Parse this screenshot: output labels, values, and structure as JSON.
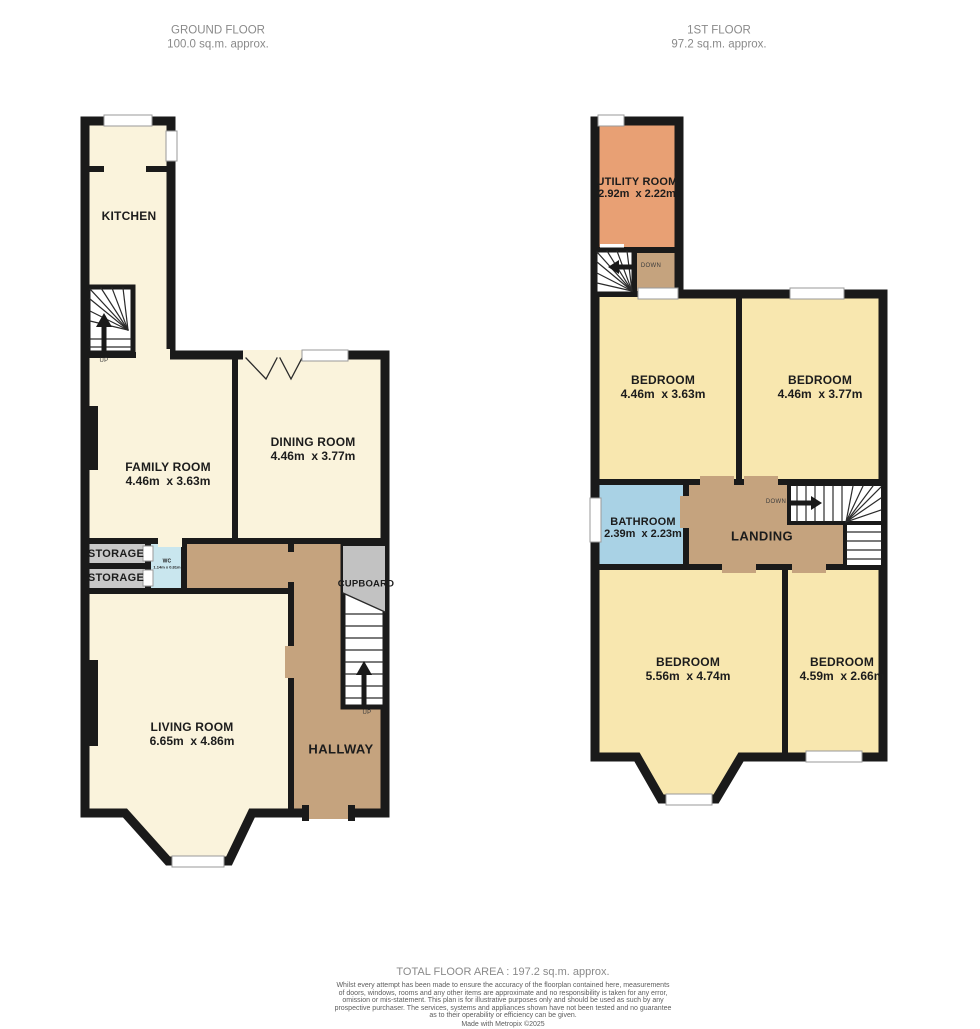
{
  "headers": {
    "ground": {
      "title": "GROUND FLOOR",
      "area": "100.0 sq.m. approx."
    },
    "first": {
      "title": "1ST FLOOR",
      "area": "97.2 sq.m. approx."
    }
  },
  "ground_floor": {
    "rooms": {
      "kitchen": {
        "name": "KITCHEN"
      },
      "family": {
        "name": "FAMILY ROOM",
        "dims": "4.46m  x 3.63m"
      },
      "dining": {
        "name": "DINING ROOM",
        "dims": "4.46m  x 3.77m"
      },
      "storage1": {
        "name": "STORAGE"
      },
      "storage2": {
        "name": "STORAGE"
      },
      "wc": {
        "name": "WC",
        "dims": "1.14m x 0.81m"
      },
      "cupboard": {
        "name": "CUPBOARD"
      },
      "living": {
        "name": "LIVING ROOM",
        "dims": "6.65m  x 4.86m"
      },
      "hallway": {
        "name": "HALLWAY"
      }
    },
    "stairs": {
      "up_kitchen": "UP",
      "up_hall": "UP"
    }
  },
  "first_floor": {
    "rooms": {
      "utility": {
        "name": "UTILITY ROOM",
        "dims": "2.92m  x 2.22m"
      },
      "bed_tl": {
        "name": "BEDROOM",
        "dims": "4.46m  x 3.63m"
      },
      "bed_tr": {
        "name": "BEDROOM",
        "dims": "4.46m  x 3.77m"
      },
      "bathroom": {
        "name": "BATHROOM",
        "dims": "2.39m  x 2.23m"
      },
      "landing": {
        "name": "LANDING"
      },
      "bed_bl": {
        "name": "BEDROOM",
        "dims": "5.56m  x 4.74m"
      },
      "bed_br": {
        "name": "BEDROOM",
        "dims": "4.59m  x 2.66m"
      }
    },
    "stairs": {
      "down_top": "DOWN",
      "down_main": "DOWN"
    }
  },
  "footer": {
    "total": "TOTAL FLOOR AREA : 197.2 sq.m. approx.",
    "disclaimer_lines": [
      "Whilst every attempt has been made to ensure the accuracy of the floorplan contained here, measurements",
      "of doors, windows, rooms and any other items are approximate and no responsibility is taken for any error,",
      "omission or mis-statement. This plan is for illustrative purposes only and should be used as such by any",
      "prospective purchaser. The services, systems and appliances shown have not been tested and no guarantee",
      "as to their operability or efficiency can be given."
    ],
    "made_with": "Made with Metropix ©2025"
  },
  "colors": {
    "wall": "#1a1a1a",
    "room_cream": "#FAF3DC",
    "room_yellow": "#F8E7AF",
    "hall_tan": "#C5A37E",
    "utility_orange": "#E8A074",
    "bathroom_blue": "#A9D2E5",
    "wc_cyan": "#C9E6EE",
    "storage_grey": "#C9C9C9",
    "cupboard_grey": "#C2C2C2"
  }
}
